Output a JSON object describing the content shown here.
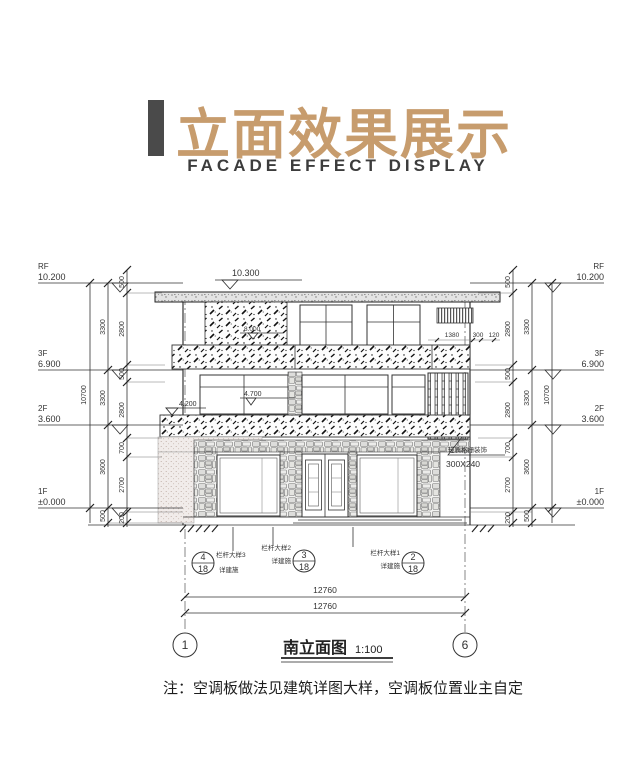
{
  "title": {
    "zh": "立面效果展示",
    "en": "FACADE EFFECT DISPLAY"
  },
  "colors": {
    "accent": "#c79c6d",
    "bar": "#4a4a4a",
    "line": "#333333"
  },
  "levels": {
    "left": [
      {
        "name": "RF",
        "elev": "10.200"
      },
      {
        "name": "3F",
        "elev": "6.900"
      },
      {
        "name": "2F",
        "elev": "3.600"
      },
      {
        "name": "1F",
        "elev": "±0.000"
      }
    ],
    "right": [
      {
        "name": "RF",
        "elev": "10.200"
      },
      {
        "name": "3F",
        "elev": "6.900"
      },
      {
        "name": "2F",
        "elev": "3.600"
      },
      {
        "name": "1F",
        "elev": "±0.000"
      }
    ]
  },
  "markers": {
    "roof_top": "10.300",
    "wall": "8.000",
    "canopy": "4.700",
    "balcony": "4.200"
  },
  "dims": {
    "left": {
      "outer": [
        "10700"
      ],
      "middle": [
        "3300",
        "3300",
        "3600",
        "500"
      ],
      "inner": [
        "500",
        "2800",
        "500",
        "2800",
        "700",
        "2700",
        "200"
      ]
    },
    "right": {
      "outer": [
        "10700"
      ],
      "middle": [
        "3300",
        "3300",
        "3600",
        "500"
      ],
      "inner": [
        "500",
        "2800",
        "500",
        "2800",
        "700",
        "2700",
        "200"
      ]
    },
    "grille": [
      "1380",
      "300",
      "120"
    ],
    "bottom": [
      "12760",
      "12760"
    ]
  },
  "grille_note": {
    "line1": "轻质格栅装饰",
    "line2": "300X240"
  },
  "callouts": [
    {
      "num": "4",
      "den": "18",
      "label": "栏杆大样3",
      "sub": "详建施"
    },
    {
      "num": "3",
      "den": "18",
      "label": "栏杆大样2",
      "sub": "详建施"
    },
    {
      "num": "2",
      "den": "18",
      "label": "栏杆大样1",
      "sub": "详建施"
    }
  ],
  "axes": [
    "1",
    "6"
  ],
  "caption": {
    "title": "南立面图",
    "scale": "1:100"
  },
  "note": "注：空调板做法见建筑详图大样，空调板位置业主自定"
}
